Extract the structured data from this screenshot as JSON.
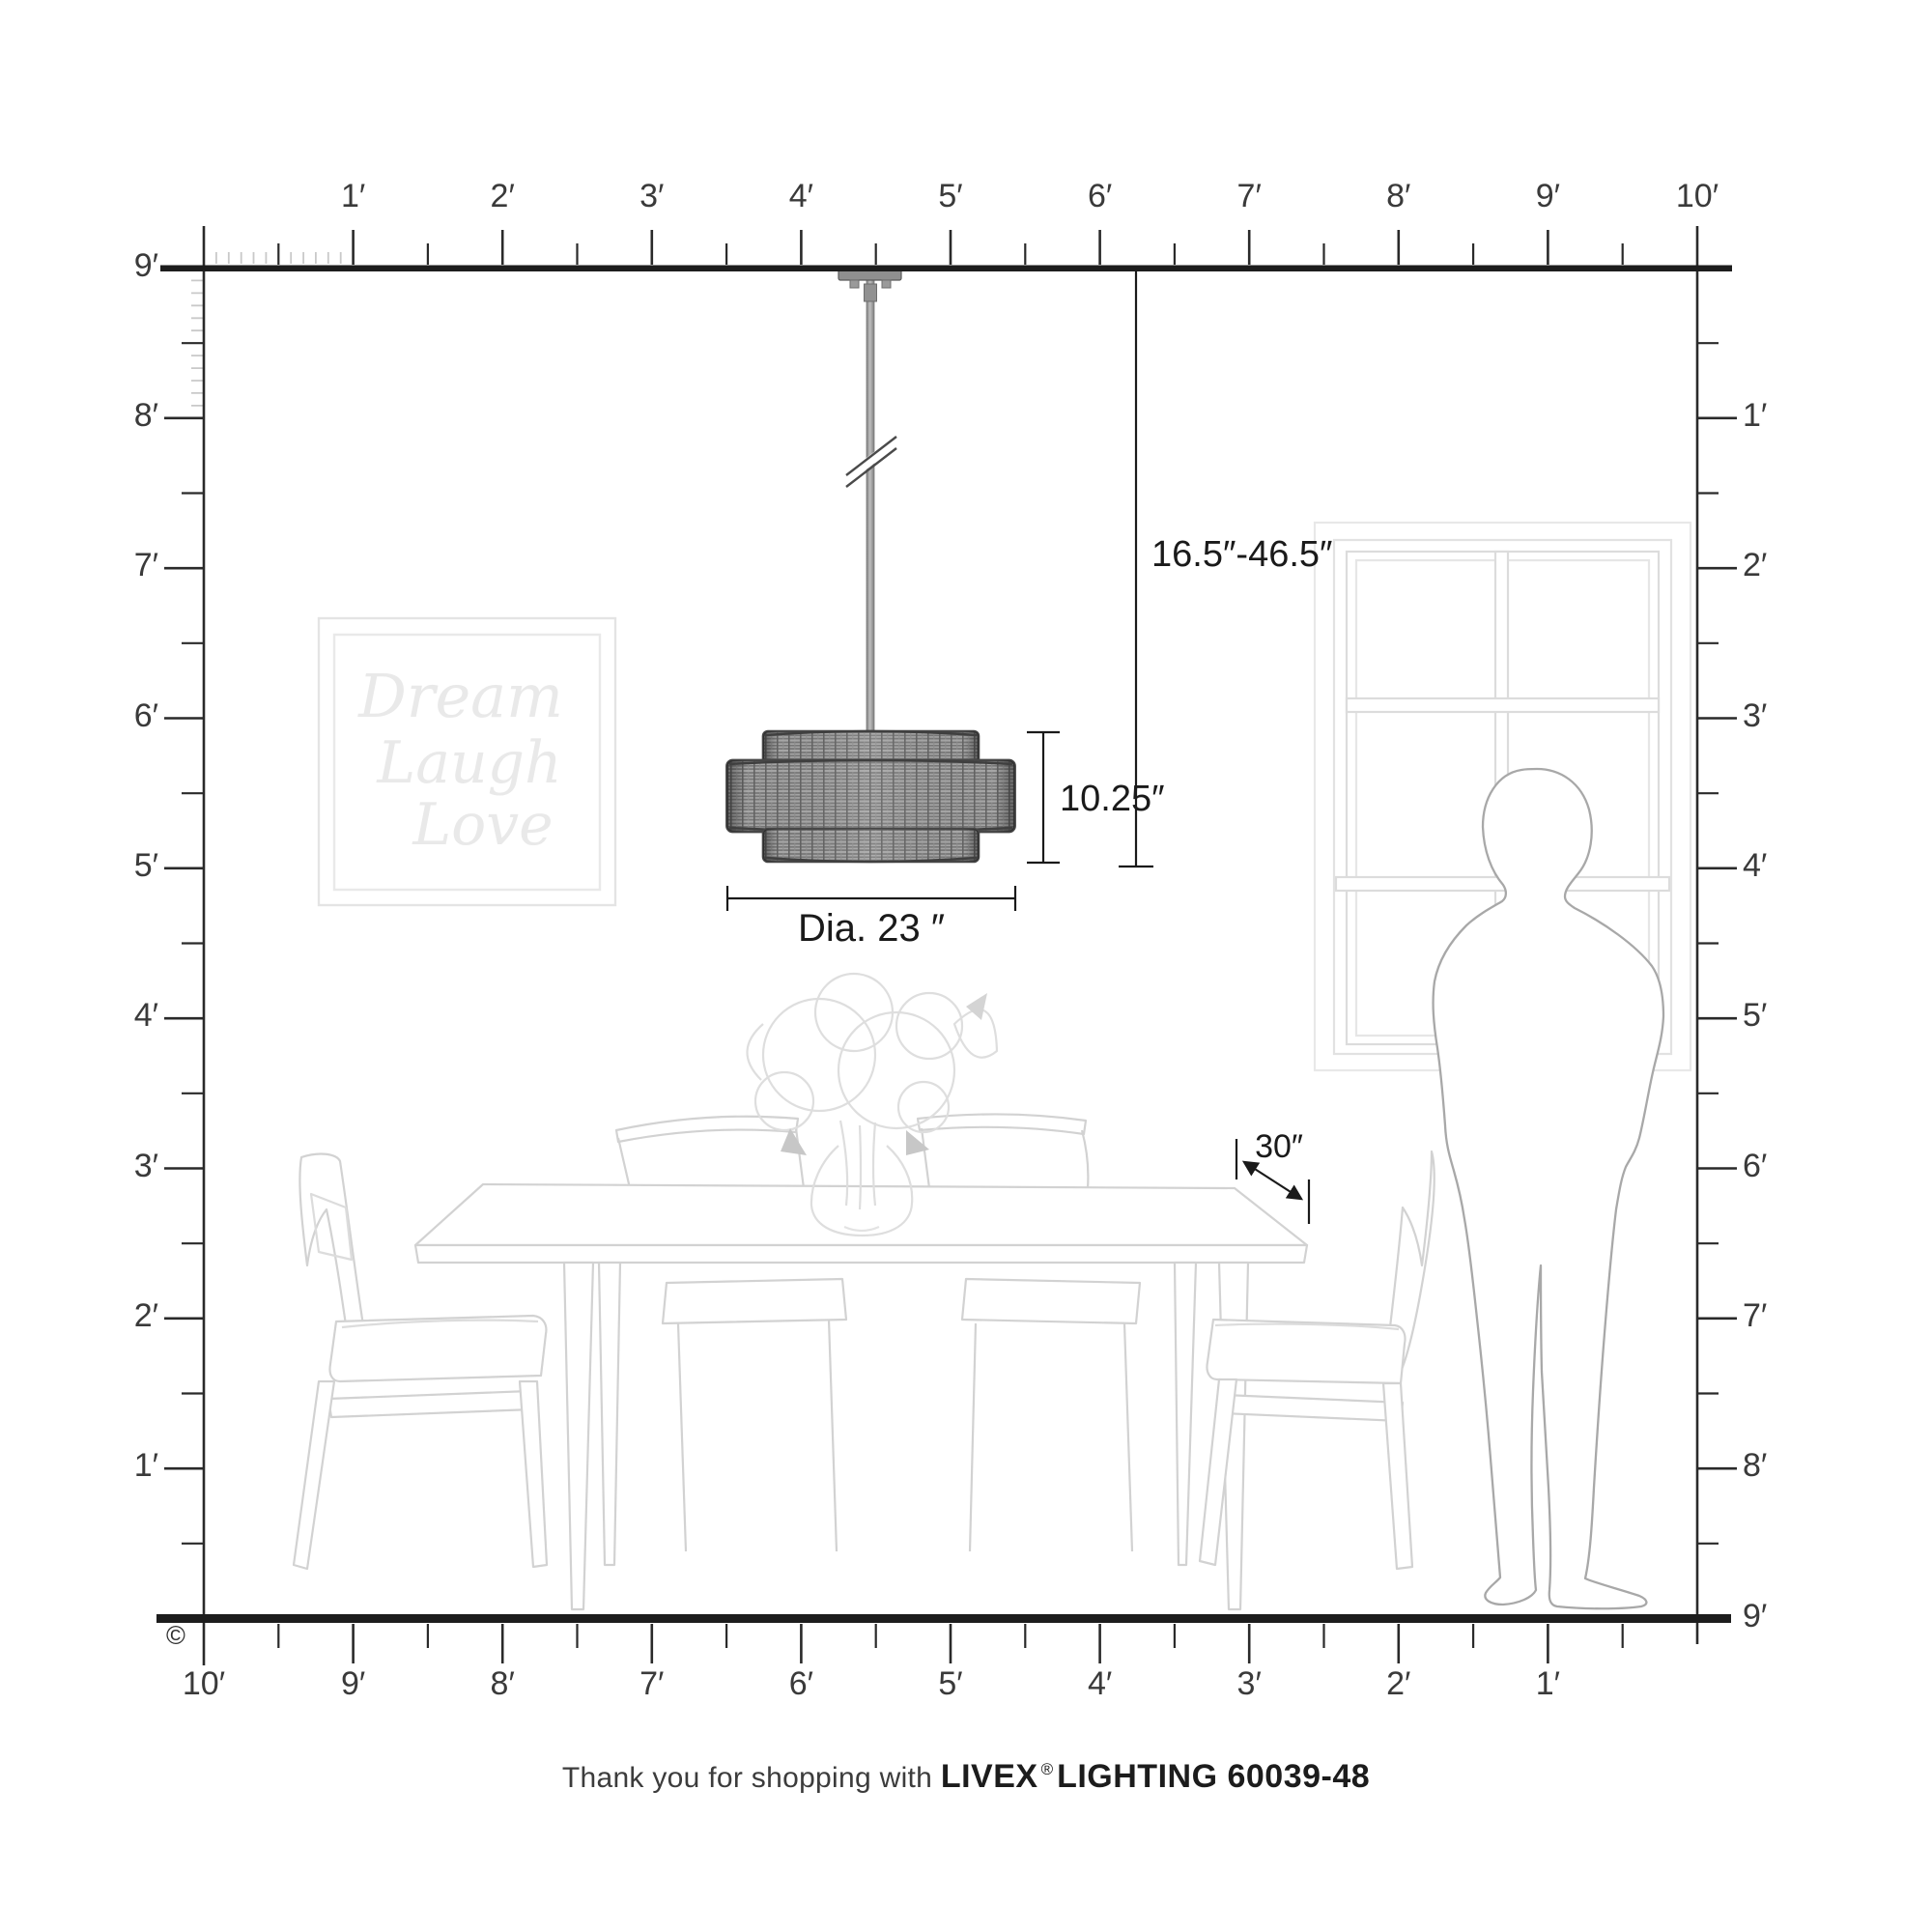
{
  "copyright": "©",
  "footer": {
    "thanks": "Thank you for shopping with ",
    "brand": "LIVEX",
    "reg": "®",
    "rest": "LIGHTING 60039-48"
  },
  "dimensions": {
    "hanging_range": "16.5″-46.5″",
    "fixture_height": "10.25″",
    "diameter": "Dia. 23 ″",
    "table_clearance": "30″"
  },
  "wall_art": {
    "lines": [
      "Dream",
      "Laugh",
      "Love"
    ]
  },
  "rulers": {
    "top": {
      "labels": [
        "1′",
        "2′",
        "3′",
        "4′",
        "5′",
        "6′",
        "7′",
        "8′",
        "9′",
        "10′"
      ]
    },
    "left": {
      "labels": [
        "9′",
        "8′",
        "7′",
        "6′",
        "5′",
        "4′",
        "3′",
        "2′",
        "1′"
      ]
    },
    "right": {
      "labels": [
        "1′",
        "2′",
        "3′",
        "4′",
        "5′",
        "6′",
        "7′",
        "8′",
        "9′"
      ]
    },
    "bottom": {
      "labels": [
        "10′",
        "9′",
        "8′",
        "7′",
        "6′",
        "5′",
        "4′",
        "3′",
        "2′",
        "1′"
      ]
    }
  },
  "colors": {
    "ruler_line": "#1d1d1d",
    "tick": "#2a2a2a",
    "inch_tick": "#c9c9c9",
    "dimension": "#1a1a1a",
    "furniture_line": "#d2d2d2",
    "art_line": "#e4e4e4",
    "person_line": "#a8a8a8",
    "shade_weave": "#a6a6a6",
    "shade_rim": "#474747"
  }
}
